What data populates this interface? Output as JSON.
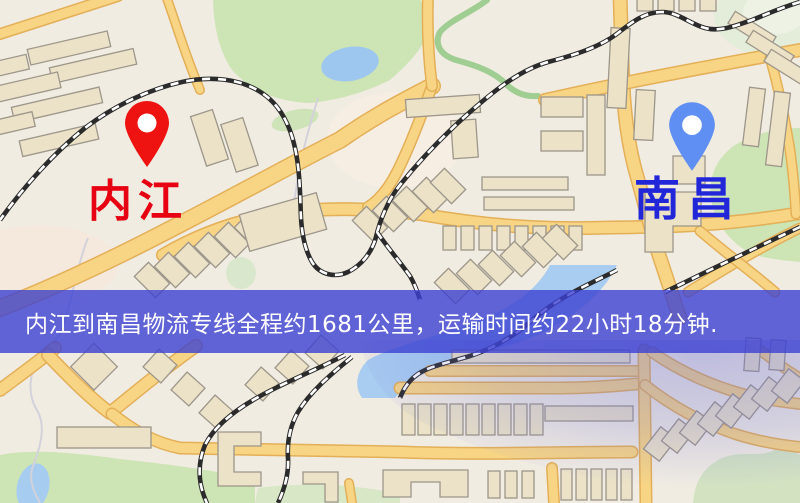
{
  "banner": {
    "text": "内江到南昌物流专线全程约1681公里，运输时间约22小时18分钟."
  },
  "route": {
    "origin": "内江",
    "destination": "南昌",
    "distance_km": "1681",
    "duration_text": "22小时18分钟"
  },
  "markers": {
    "origin": {
      "label": "内江"
    },
    "destination": {
      "label": "南昌"
    }
  },
  "colors": {
    "bg": "#f1ece2",
    "banner_bg": "rgba(60,65,210,0.8)",
    "origin_color": "#e60012",
    "dest_color": "#2126d8",
    "pin_origin": "#ee1310",
    "pin_dest": "#5f8ff2",
    "road": "#f8d585",
    "road_border": "#e3af57",
    "rail": "#2b2b2b",
    "park": "#cde4b5",
    "water": "#a8cdf1"
  }
}
